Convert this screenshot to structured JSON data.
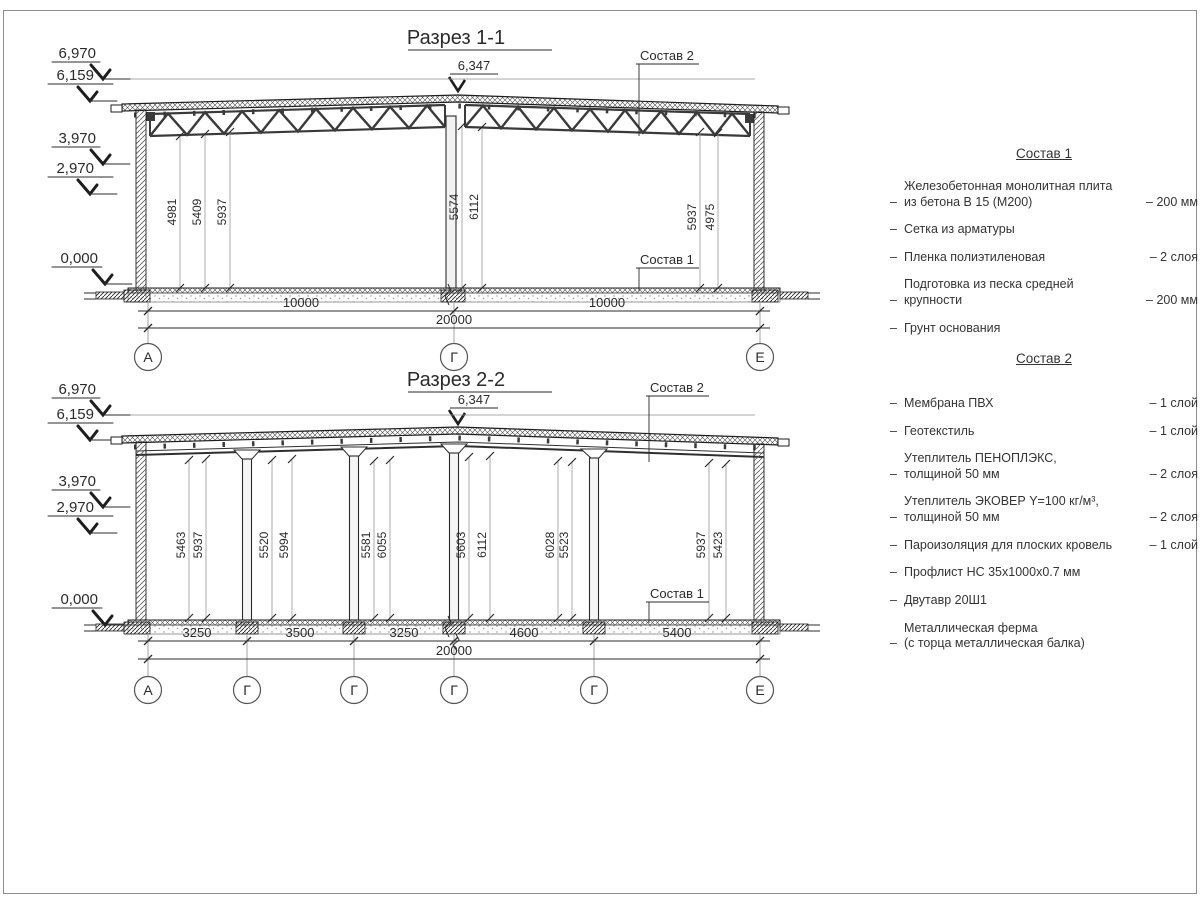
{
  "section1": {
    "title": "Разрез 1-1",
    "ridge_dim": "6,347",
    "elevations": [
      "6,970",
      "6,159",
      "3,970",
      "2,970",
      "0,000"
    ],
    "height_dims": [
      "4981",
      "5409",
      "5937",
      "5574",
      "6112",
      "5937",
      "4975"
    ],
    "span_dims": [
      "10000",
      "10000"
    ],
    "total_dim": "20000",
    "axes": [
      "А",
      "Г",
      "Е"
    ],
    "label_top": "Состав 2",
    "label_floor": "Состав 1"
  },
  "section2": {
    "title": "Разрез 2-2",
    "ridge_dim": "6,347",
    "elevations": [
      "6,970",
      "6,159",
      "3,970",
      "2,970",
      "0,000"
    ],
    "height_dims": [
      "5463",
      "5937",
      "5520",
      "5994",
      "5581",
      "6055",
      "5603",
      "6112",
      "6028",
      "5523",
      "5937",
      "5423"
    ],
    "span_dims": [
      "3250",
      "3500",
      "3250",
      "4600",
      "5400"
    ],
    "total_dim": "20000",
    "axes": [
      "А",
      "Г",
      "Г",
      "Г",
      "Г",
      "Е"
    ],
    "label_top": "Состав 2",
    "label_floor": "Состав 1"
  },
  "sostav1": {
    "title": "Состав 1",
    "bullet": "–",
    "items": [
      {
        "text": "Железобетонная  монолитная плита\nиз бетона В 15 (М200)",
        "qty": "– 200 мм"
      },
      {
        "text": "Сетка из арматуры",
        "qty": ""
      },
      {
        "text": "Пленка полиэтиленовая",
        "qty": "– 2 слоя"
      },
      {
        "text": "Подготовка из песка средней\nкрупности",
        "qty": "– 200 мм"
      },
      {
        "text": "Грунт основания",
        "qty": ""
      }
    ]
  },
  "sostav2": {
    "title": "Состав 2",
    "bullet": "–",
    "items": [
      {
        "text": "Мембрана ПВХ",
        "qty": "– 1 слой"
      },
      {
        "text": "Геотекстиль",
        "qty": "– 1 слой"
      },
      {
        "text": "Утеплитель ПЕНОПЛЭКС,\nтолщиной 50 мм",
        "qty": "– 2 слоя"
      },
      {
        "text": "Утеплитель ЭКОВЕР Y=100 кг/м³,\nтолщиной 50 мм",
        "qty": "– 2 слоя"
      },
      {
        "text": "Пароизоляция для плоских кровель",
        "qty": "– 1 слой"
      },
      {
        "text": "Профлист НС 35х1000х0.7 мм",
        "qty": ""
      },
      {
        "text": "Двутавр 20Ш1",
        "qty": ""
      },
      {
        "text": "Металлическая ферма\n(с торца металлическая балка)",
        "qty": ""
      }
    ]
  }
}
